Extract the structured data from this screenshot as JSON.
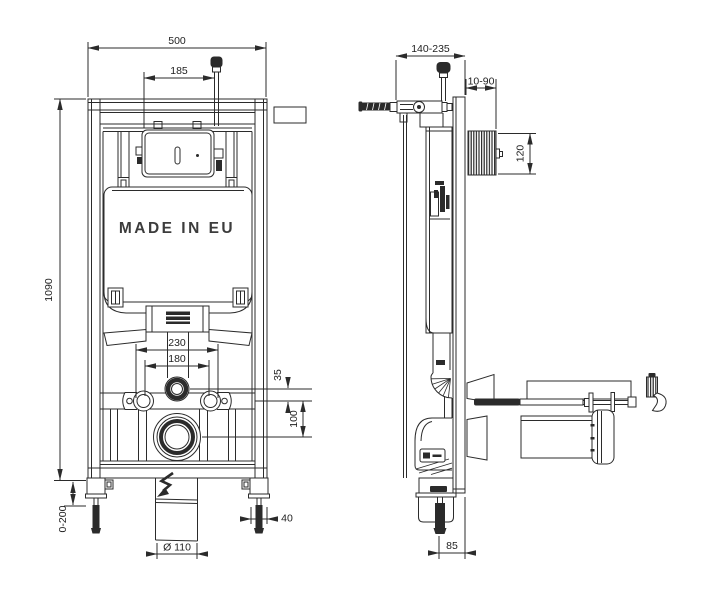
{
  "colors": {
    "background": "#ffffff",
    "line": "#2b2b2b"
  },
  "stamp": {
    "label": "MADE IN EU"
  },
  "front_view": {
    "dim_frame_width": "500",
    "dim_supply_offset": "185",
    "dim_frame_height": "1090",
    "dim_foot_adjustment": "0-200",
    "dim_fixing_spacing_outer": "230",
    "dim_fixing_spacing_inner": "180",
    "dim_axis_offset_small": "35",
    "dim_axis_offset_large": "100",
    "dim_foot_width": "40",
    "dim_outlet_diameter": "Ø 110"
  },
  "side_view": {
    "dim_frame_depth_range": "140-235",
    "dim_wall_distance_range": "10-90",
    "dim_access_box_height": "120",
    "dim_outlet_wall_offset": "85"
  }
}
